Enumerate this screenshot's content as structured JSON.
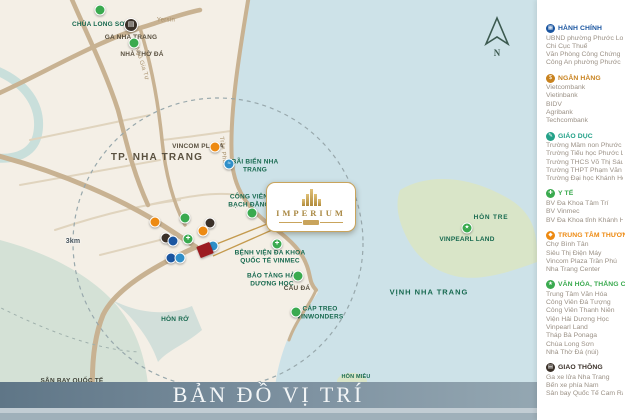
{
  "title_bar": {
    "text": "BẢN ĐỒ VỊ TRÍ"
  },
  "compass": {
    "north": "N"
  },
  "icons": {
    "train": "▤",
    "plane": "✈",
    "star": "★",
    "cross": "✚",
    "wave": "≈"
  },
  "colors": {
    "accent_gold": "#c9a45c",
    "project_red": "#9c1b20",
    "admin_blue": "#1a55a0",
    "bank_orange": "#c8821e",
    "edu_teal": "#23a188",
    "health_green": "#3aaa4f",
    "mall_orange": "#ed8a12",
    "transport_dark": "#3a3028"
  },
  "map": {
    "project_name": "IMPERIUM",
    "city_label": "TP. NHA TRANG",
    "scale_label": "3km",
    "labels": {
      "chua_long_son": "CHÙA LONG SƠN",
      "ga_nha_trang": "GA NHA TRANG",
      "nha_tho_da": "NHÀ THỜ ĐÁ",
      "street_yersin": "Yersin",
      "street_ngo_gia_tu": "Ngô Gia Tự",
      "street_tran_phu": "Trần Phú",
      "vincom_plaza": "VINCOM PLAZA",
      "bai_bien_nha_trang": "BÃI BIỂN NHA TRANG",
      "cong_vien_bach_dang": "CÔNG VIÊN BẠCH ĐẰNG",
      "benh_vien_vinmec": "BỆNH VIỆN ĐA KHOA QUỐC TẾ VINMEC",
      "bao_tang_hai_duong_hoc": "BẢO TÀNG HẢI DƯƠNG HỌC",
      "cau_da": "CẦU ĐÁ",
      "cap_treo_vinwonders": "CÁP TREO VINWONDERS",
      "hon_ro": "HÒN RỚ",
      "hon_tre": "HÒN TRE",
      "vinpearl_land": "VINPEARL LAND",
      "vinh_nha_trang": "VỊNH NHA TRANG",
      "hon_mieu": "HÒN MIỄU",
      "san_bay_cam_ranh": "SÂN BAY QUỐC TẾ CAM RANH"
    }
  },
  "legend": {
    "categories": [
      {
        "title": "HÀNH CHÍNH",
        "color": "#1a55a0",
        "icon": "government-building-icon",
        "glyph": "▦",
        "items": [
          "UBND phường Phước Long",
          "Chi Cục Thuế",
          "Văn Phòng Công Chứng",
          "Công An phường Phước Long"
        ]
      },
      {
        "title": "NGÂN HÀNG",
        "color": "#c8821e",
        "icon": "bank-dollar-icon",
        "glyph": "$",
        "items": [
          "Vietcombank",
          "Vietinbank",
          "BIDV",
          "Agribank",
          "Techcombank"
        ]
      },
      {
        "title": "GIÁO DỤC",
        "color": "#23a188",
        "icon": "education-icon",
        "glyph": "✎",
        "items": [
          "Trường Mầm non Phước Long",
          "Trường Tiểu học Phước Long 2",
          "Trường THCS Võ Thị Sáu",
          "Trường THPT Phạm Văn Đồng",
          "Trường Đại học Khánh Hòa"
        ]
      },
      {
        "title": "Y TẾ",
        "color": "#3aaa4f",
        "icon": "medical-cross-icon",
        "glyph": "✚",
        "items": [
          "BV Đa Khoa Tâm Trí",
          "BV Vinmec",
          "BV Đa Khoa tỉnh Khánh Hòa"
        ]
      },
      {
        "title": "TRUNG TÂM THƯƠNG MẠI",
        "color": "#ed8a12",
        "icon": "shopping-icon",
        "glyph": "◆",
        "items": [
          "Chợ Bình Tân",
          "Siêu Thị Điện Máy",
          "Vincom Plaza Trần Phú",
          "Nha Trang Center"
        ]
      },
      {
        "title": "VĂN HÓA, THẮNG CẢNH",
        "color": "#3aaa4f",
        "icon": "scenic-star-icon",
        "glyph": "★",
        "items": [
          "Trung Tâm Văn Hóa",
          "Công Viên Đá Tượng",
          "Công Viên Thanh Niên",
          "Viện Hải Dương Học",
          "Vinpearl Land",
          "Tháp Bà Ponaga",
          "Chùa Long Sơn",
          "Nhà Thờ Đá (núi)"
        ]
      },
      {
        "title": "GIAO THÔNG",
        "color": "#3a3028",
        "icon": "transport-train-icon",
        "glyph": "▤",
        "items": [
          "Ga xe lửa Nha Trang",
          "Bến xe phía Nam",
          "Sân bay Quốc Tế Cam Ranh"
        ]
      }
    ]
  }
}
